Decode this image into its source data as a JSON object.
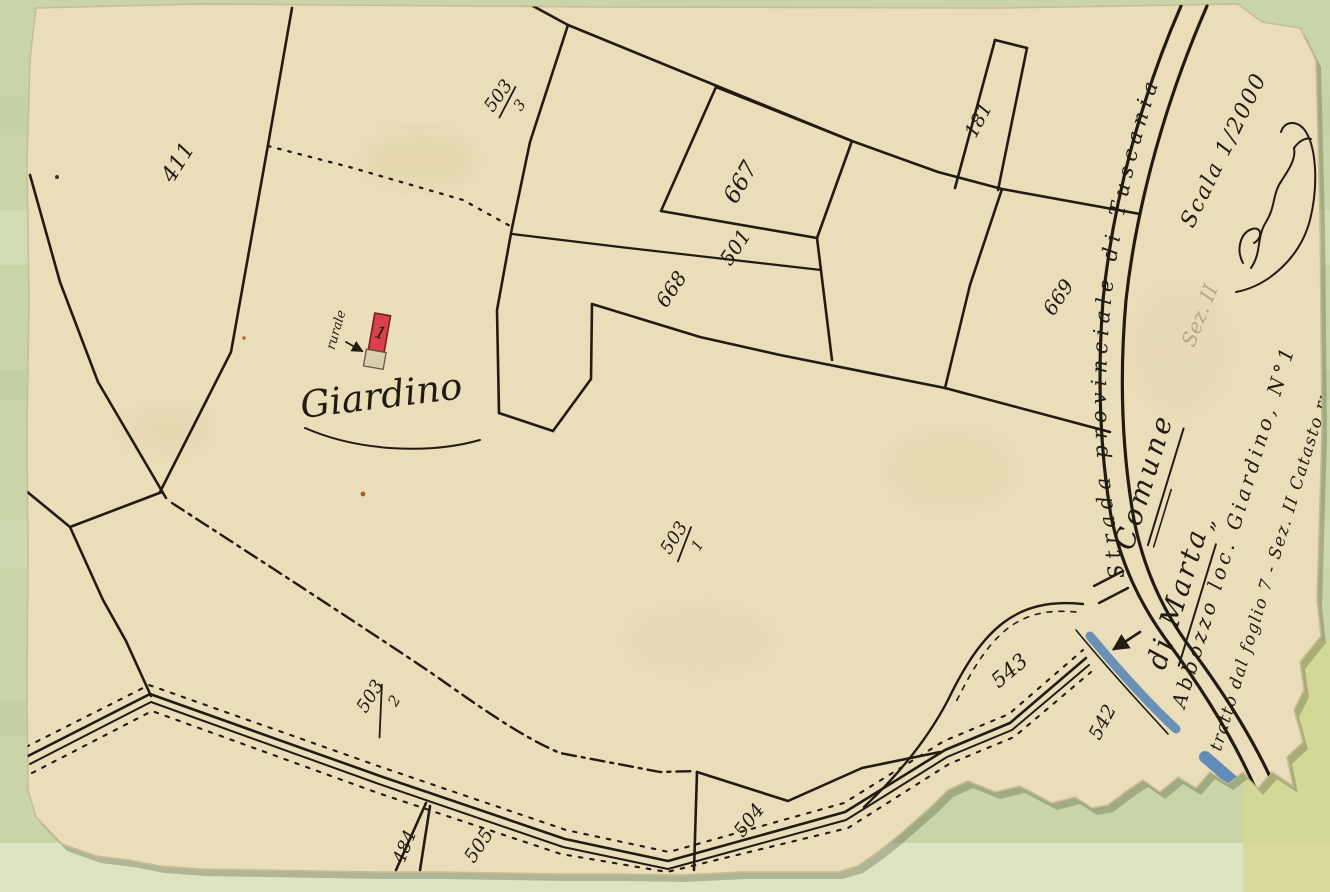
{
  "map": {
    "colors": {
      "background": "#c9d4a8",
      "paper": "#ece0bc",
      "ink": "#221b11",
      "water": "#4a7cb8",
      "building_fill": "#d7424d"
    },
    "labels": {
      "p411": "411",
      "p667": "667",
      "p501": "501",
      "p668": "668",
      "p181": "181",
      "p669": "669",
      "p543": "543",
      "p542": "542",
      "p504": "504",
      "p505": "505",
      "p484": "484"
    },
    "fractions": {
      "f503_3": {
        "num": "503",
        "den": "3"
      },
      "f503_1": {
        "num": "503",
        "den": "1"
      },
      "f503_2": {
        "num": "503",
        "den": "2"
      }
    },
    "annotations": {
      "locality": "Giardino",
      "building_note": "rurale",
      "building_number": "1",
      "road_name": "Strada provinciale di Tuscania",
      "scale": "Scala 1/2000",
      "commune_line1": "Comune",
      "commune_line2": "di Marta",
      "marta_mark": "„",
      "title_line1": "Abbozzo loc. Giardino, N°1",
      "title_line2": "tratto dal foglio 7 - Sez. II Catasto rustico",
      "pencil_note": "Sez. II"
    }
  }
}
